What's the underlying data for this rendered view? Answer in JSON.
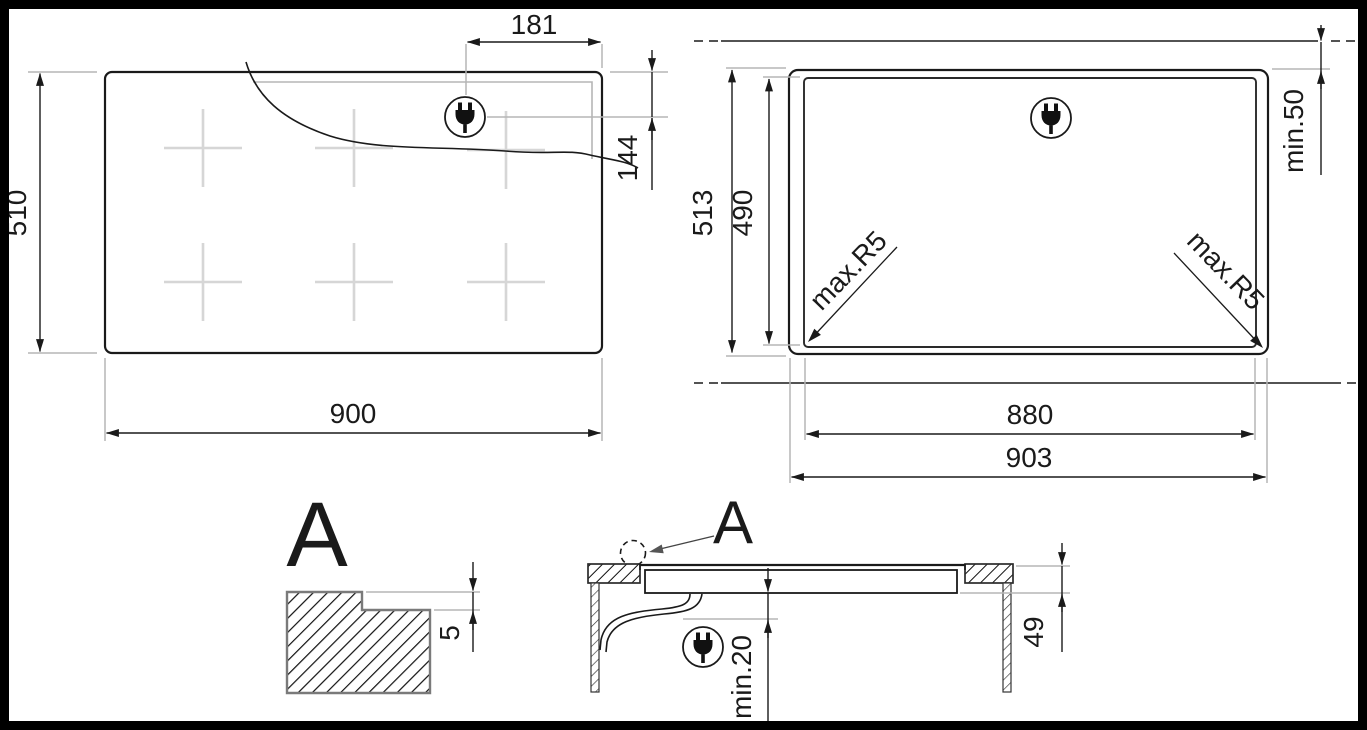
{
  "drawing": {
    "plan_view": {
      "width_label": "900",
      "height_label": "510",
      "plug_offset_x_label": "181",
      "plug_offset_y_label": "144"
    },
    "cutout_view": {
      "outer_width_label": "903",
      "inner_width_label": "880",
      "outer_height_label": "513",
      "inner_height_label": "490",
      "min_distance_label": "min.50",
      "corner_radius_left_label": "max.R5",
      "corner_radius_right_label": "max.R5"
    },
    "detail_view": {
      "title_label": "A",
      "rebate_depth_label": "5"
    },
    "section_view": {
      "callout_label": "A",
      "min_clearance_label": "min.20",
      "depth_below_top_label": "49"
    },
    "icons": {
      "plug": "power-plug-icon",
      "detail_callout": "detail-callout-circle"
    },
    "colors": {
      "line": "#1a1a1a",
      "extension_line": "#b5b5b5",
      "burner_cross": "#d6d6d6",
      "hatch_outline": "#7a7a7a",
      "callout_arrow": "#555555",
      "background": "#ffffff",
      "frame": "#000000"
    }
  }
}
